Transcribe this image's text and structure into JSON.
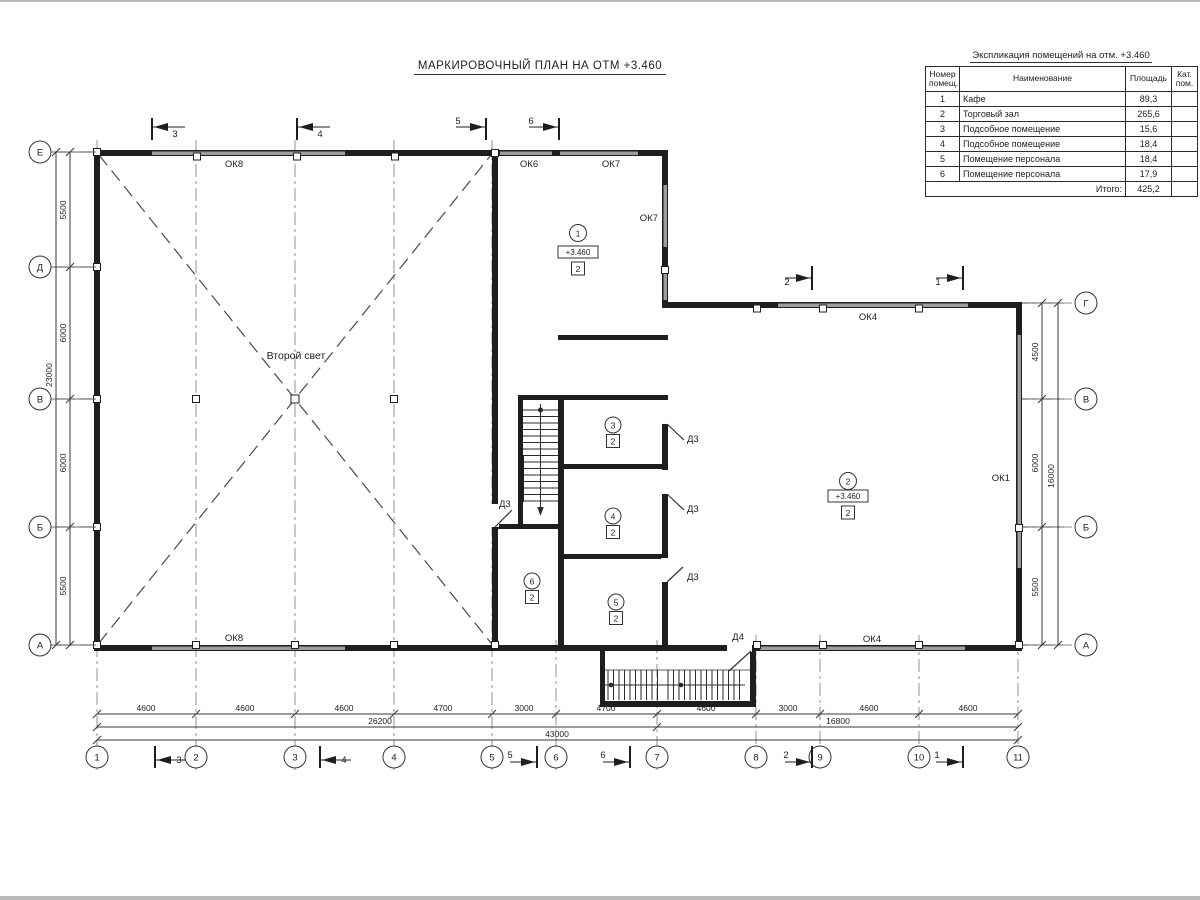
{
  "page": {
    "title": "МАРКИРОВОЧНЫЙ ПЛАН НА ОТМ +3.460"
  },
  "table": {
    "caption": "Экспликация помещений на отм. +3.460",
    "col_num1": "Номер",
    "col_num2": "помещ.",
    "col_name": "Наименование",
    "col_area": "Площадь",
    "col_cat1": "Кат.",
    "col_cat2": "пом.",
    "rows": [
      {
        "num": "1",
        "name": "Кафе",
        "area": "89,3"
      },
      {
        "num": "2",
        "name": "Торговый зал",
        "area": "265,6"
      },
      {
        "num": "3",
        "name": "Подсобное помещение",
        "area": "15,6"
      },
      {
        "num": "4",
        "name": "Подсобное помещение",
        "area": "18,4"
      },
      {
        "num": "5",
        "name": "Помещение персонала",
        "area": "18,4"
      },
      {
        "num": "6",
        "name": "Помещение персонала",
        "area": "17,9"
      }
    ],
    "total_label": "Итого:",
    "total_value": "425,2"
  },
  "plan": {
    "second_light": "Второй свет",
    "rooms": {
      "r1": {
        "num": "1",
        "elev": "+3.460",
        "finish": "2"
      },
      "r2": {
        "num": "2",
        "elev": "+3.460",
        "finish": "2"
      },
      "r3": {
        "num": "3",
        "finish": "2"
      },
      "r4": {
        "num": "4",
        "finish": "2"
      },
      "r5": {
        "num": "5",
        "finish": "2"
      },
      "r6": {
        "num": "6",
        "finish": "2"
      }
    },
    "windows": {
      "ok8": "ОК8",
      "ok6": "ОК6",
      "ok7": "ОК7",
      "ok4": "ОК4",
      "ok1": "ОК1"
    },
    "doors": {
      "d3": "Д3",
      "d4": "Д4"
    }
  },
  "axes": {
    "bottom": [
      "1",
      "2",
      "3",
      "4",
      "5",
      "6",
      "7",
      "8",
      "9",
      "10",
      "11"
    ],
    "left": [
      "Е",
      "Д",
      "В",
      "Б",
      "А"
    ],
    "right": [
      "Г",
      "В",
      "Б",
      "А"
    ]
  },
  "dims": {
    "bottom": [
      "4600",
      "4600",
      "4600",
      "4700",
      "3000",
      "4700",
      "4600",
      "3000",
      "4600",
      "4600"
    ],
    "bottom_sub": [
      "26200",
      "16800"
    ],
    "bottom_total": "43000",
    "left": [
      "5500",
      "6000",
      "6000",
      "5500"
    ],
    "left_total": "23000",
    "right": [
      "4500",
      "6000",
      "5500"
    ],
    "right_total": "16000"
  },
  "markers": {
    "m1": "1",
    "m2": "2",
    "m3": "3",
    "m4": "4",
    "m5": "5",
    "m6": "6"
  }
}
